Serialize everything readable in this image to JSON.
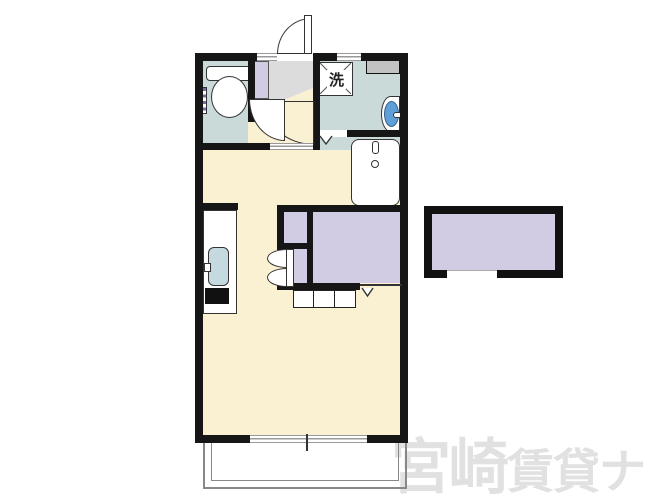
{
  "plan": {
    "laundry_label": "洗",
    "watermark": {
      "primary": "宮崎",
      "secondary": "賃貸ナビ"
    },
    "colors": {
      "room_floor": "#FAF0D2",
      "wet_area_floor": "#C9DAD9",
      "storage_fill": "#D1CCE3",
      "entrance_floor": "#DCDCDC",
      "wall": "#161616",
      "basin_blue": "#5F9FD8",
      "sink_blue": "#C4DAE0",
      "watermark_gray": "#E1E1E1"
    },
    "fixtures": {
      "toilet": "toilet-icon",
      "washing_machine_pan": "washing-pan-icon",
      "wash_basin": "basin-icon",
      "bathtub": "bathtub-icon",
      "kitchen_sink": "sink-icon",
      "stove": "stove-icon",
      "closet": "closet-area",
      "balcony": "balcony-outline",
      "storage_box": "detached-storage"
    }
  }
}
